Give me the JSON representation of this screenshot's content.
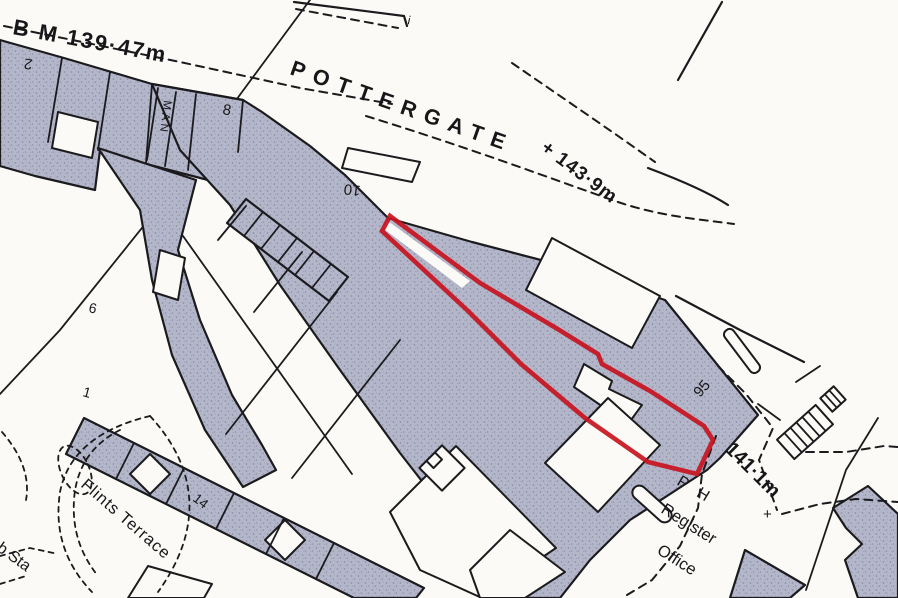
{
  "map": {
    "type": "ordnance-survey-site-plan",
    "streets": {
      "pottergate": "POTTERGATE",
      "flints_terrace": "Flints Terrace"
    },
    "annotations": {
      "bench_mark": "B M 139·47m",
      "spot_height_pottergate": "+ 143·9m",
      "spot_height_lower": "141·1m",
      "spot_marker": "+",
      "tick": "i",
      "public_house": "P H",
      "register_office_1": "Register",
      "register_office_2": "Office",
      "sub_station": "b Sta",
      "passage": "MAN"
    },
    "house_numbers": {
      "no_2": "2",
      "no_8": "8",
      "no_10": "10",
      "no_6": "6",
      "no_1": "1",
      "no_14": "14",
      "no_95": "95"
    },
    "colors": {
      "plot_outline": "#c81420",
      "building_fill": "#b4b6ca",
      "building_speckle": "#8f91a9",
      "ink": "#1b1b1e",
      "paper": "#fbfaf6"
    }
  }
}
